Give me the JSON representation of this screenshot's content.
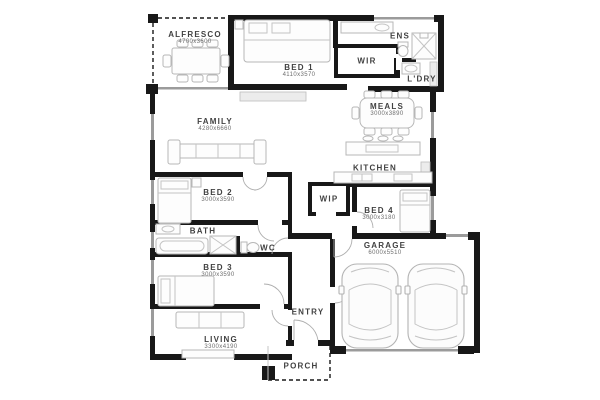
{
  "figure_type": "house-floor-plan",
  "rooms": {
    "alfresco": {
      "name": "ALFRESCO",
      "dims": "4700x3600"
    },
    "bed1": {
      "name": "BED 1",
      "dims": "4110x3570"
    },
    "ens": {
      "name": "ENS",
      "dims": ""
    },
    "wir": {
      "name": "WIR",
      "dims": ""
    },
    "ldry": {
      "name": "L'DRY",
      "dims": ""
    },
    "meals": {
      "name": "MEALS",
      "dims": "3000x3890"
    },
    "family": {
      "name": "FAMILY",
      "dims": "4280x6660"
    },
    "kitchen": {
      "name": "KITCHEN",
      "dims": ""
    },
    "wip": {
      "name": "WIP",
      "dims": ""
    },
    "bed2": {
      "name": "BED 2",
      "dims": "3000x3590"
    },
    "bed4": {
      "name": "BED 4",
      "dims": "3000x3180"
    },
    "bath": {
      "name": "BATH",
      "dims": ""
    },
    "wc": {
      "name": "WC",
      "dims": ""
    },
    "bed3": {
      "name": "BED 3",
      "dims": "3000x3590"
    },
    "garage": {
      "name": "GARAGE",
      "dims": "6000x5510"
    },
    "entry": {
      "name": "ENTRY",
      "dims": ""
    },
    "living": {
      "name": "LIVING",
      "dims": "3300x4190"
    },
    "porch": {
      "name": "PORCH",
      "dims": ""
    }
  },
  "colors": {
    "wall": "#181818",
    "furniture": "#b7b7b7",
    "label": "#414141"
  }
}
